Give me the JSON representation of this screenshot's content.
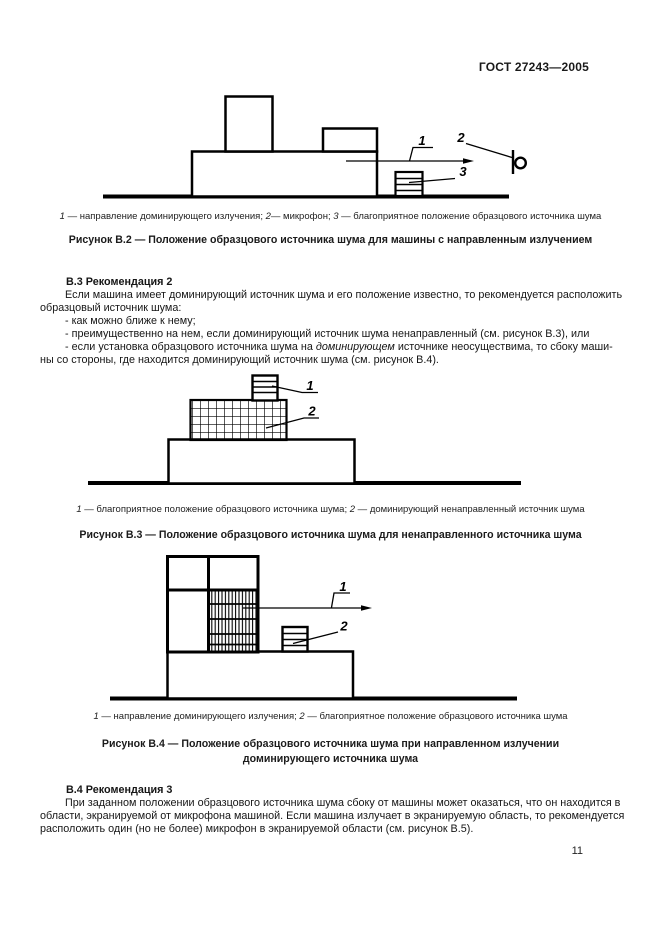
{
  "header": {
    "doc_code": "ГОСТ 27243—2005"
  },
  "fig_b2": {
    "labels": {
      "n1": "1",
      "n2": "2",
      "n3": "3"
    },
    "caption": {
      "s1": "1",
      "s2": " — направление доминирующего излучения; ",
      "s3": "2",
      "s4": "— микрофон; ",
      "s5": "3",
      "s6": " — благоприятное положение образцового источника шума"
    },
    "title": "Рисунок В.2 — Положение образцового источника шума для машины с направленным излучением"
  },
  "section_b3": {
    "heading": "В.3  Рекомендация 2",
    "para_line1": "Если машина имеет доминирующий источник шума и его положение известно, то рекомендуется расположить",
    "para_line2": "образцовый источник шума:",
    "bullet1": "- как можно ближе к нему;",
    "bullet2": "- преимущественно на нем, если доминирующий источник шума ненаправленный (см. рисунок В.3), или",
    "bullet3_seg1": "- если установка образцового источника шума на ",
    "bullet3_italic": "доминирующем",
    "bullet3_seg2": " источнике неосуществима, то сбоку маши-",
    "bullet3_line2": "ны со стороны, где находится доминирующий источник шума (см. рисунок В.4)."
  },
  "fig_b3": {
    "labels": {
      "n1": "1",
      "n2": "2"
    },
    "caption": {
      "s1": "1",
      "s2": " — благоприятное положение образцового источника шума; ",
      "s3": "2",
      "s4": " — доминирующий ненаправленный источник шума"
    },
    "title": "Рисунок В.3 — Положение образцового источника шума для ненаправленного источника шума"
  },
  "fig_b4": {
    "labels": {
      "n1": "1",
      "n2": "2"
    },
    "caption": {
      "s1": "1",
      "s2": " — направление доминирующего излучения; ",
      "s3": "2",
      "s4": " — благоприятное положение образцового источника шума"
    },
    "title_line1": "Рисунок В.4 — Положение образцового источника шума при направленном излучении",
    "title_line2": "доминирующего источника шума"
  },
  "section_b4": {
    "heading": "В.4  Рекомендация 3",
    "para_line1": "При заданном положении образцового источника шума сбоку от машины может оказаться, что он находится в",
    "para_line2": "области, экранируемой от микрофона машиной. Если машина излучает в экранируемую область, то рекомендуется",
    "para_line3": "расположить один (но не более) микрофон в экранируемой области (см. рисунок В.5)."
  },
  "footer": {
    "page_number": "11"
  }
}
